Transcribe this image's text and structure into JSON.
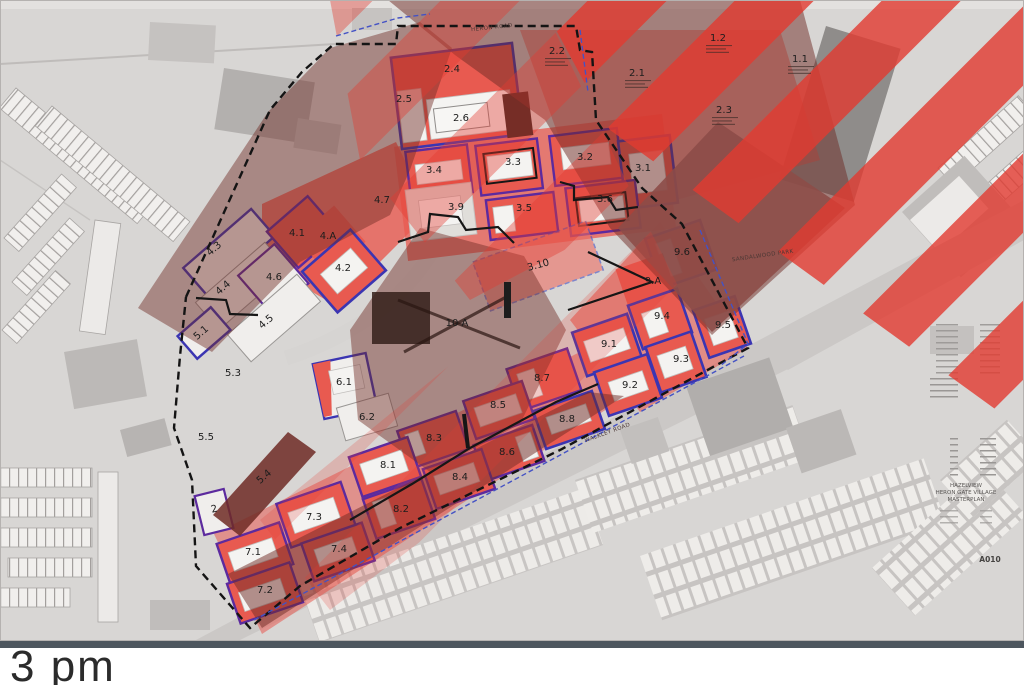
{
  "caption": {
    "text": "3 pm"
  },
  "map": {
    "colors": {
      "base": "#d8d6d4",
      "stripe": "#e23a30",
      "red": "#e85a50",
      "indigo": "#3b35b2",
      "purple": "#5c2a9e",
      "shadow": "#6e2a24",
      "park": "#8d4d48",
      "label": "#1d1d1d",
      "boundary": "#141414",
      "bar": "#4d565e",
      "caption": "#2b2b2b"
    },
    "parcel_labels": [
      {
        "t": "1.1",
        "x": 800,
        "y": 62
      },
      {
        "t": "1.2",
        "x": 718,
        "y": 41
      },
      {
        "t": "2.1",
        "x": 637,
        "y": 76
      },
      {
        "t": "2.2",
        "x": 557,
        "y": 54
      },
      {
        "t": "2.3",
        "x": 724,
        "y": 113
      },
      {
        "t": "2.4",
        "x": 452,
        "y": 72
      },
      {
        "t": "2.5",
        "x": 404,
        "y": 102
      },
      {
        "t": "2.6",
        "x": 461,
        "y": 121
      },
      {
        "t": "3.1",
        "x": 643,
        "y": 171
      },
      {
        "t": "3.2",
        "x": 585,
        "y": 160
      },
      {
        "t": "3.3",
        "x": 513,
        "y": 165
      },
      {
        "t": "3.4",
        "x": 434,
        "y": 173
      },
      {
        "t": "3.5",
        "x": 524,
        "y": 211
      },
      {
        "t": "3.6",
        "x": 605,
        "y": 202
      },
      {
        "t": "3.9",
        "x": 456,
        "y": 210
      },
      {
        "t": "3.10",
        "x": 539,
        "y": 268,
        "r": -15
      },
      {
        "t": "4.1",
        "x": 297,
        "y": 236
      },
      {
        "t": "4.A",
        "x": 328,
        "y": 239
      },
      {
        "t": "4.2",
        "x": 343,
        "y": 271
      },
      {
        "t": "4.3",
        "x": 216,
        "y": 251,
        "r": -41
      },
      {
        "t": "4.4",
        "x": 225,
        "y": 290,
        "r": -41
      },
      {
        "t": "4.5",
        "x": 268,
        "y": 324,
        "r": -41
      },
      {
        "t": "4.6",
        "x": 274,
        "y": 280
      },
      {
        "t": "4.7",
        "x": 382,
        "y": 203
      },
      {
        "t": "5.1",
        "x": 203,
        "y": 335,
        "r": -41
      },
      {
        "t": "5.3",
        "x": 233,
        "y": 376
      },
      {
        "t": "5.4",
        "x": 266,
        "y": 479,
        "r": -41
      },
      {
        "t": "5.5",
        "x": 206,
        "y": 440
      },
      {
        "t": "2",
        "x": 215,
        "y": 512,
        "r": -14
      },
      {
        "t": "6.1",
        "x": 344,
        "y": 385
      },
      {
        "t": "6.2",
        "x": 367,
        "y": 420
      },
      {
        "t": "7.1",
        "x": 253,
        "y": 555
      },
      {
        "t": "7.2",
        "x": 265,
        "y": 593
      },
      {
        "t": "7.3",
        "x": 314,
        "y": 520
      },
      {
        "t": "7.4",
        "x": 339,
        "y": 552
      },
      {
        "t": "8.1",
        "x": 388,
        "y": 468
      },
      {
        "t": "8.2",
        "x": 401,
        "y": 512
      },
      {
        "t": "8.3",
        "x": 434,
        "y": 441
      },
      {
        "t": "8.4",
        "x": 460,
        "y": 480
      },
      {
        "t": "8.5",
        "x": 498,
        "y": 408
      },
      {
        "t": "8.6",
        "x": 507,
        "y": 455
      },
      {
        "t": "8.7",
        "x": 542,
        "y": 381
      },
      {
        "t": "8.8",
        "x": 567,
        "y": 422
      },
      {
        "t": "9.1",
        "x": 609,
        "y": 347
      },
      {
        "t": "9.2",
        "x": 630,
        "y": 388
      },
      {
        "t": "9.3",
        "x": 681,
        "y": 362
      },
      {
        "t": "9.4",
        "x": 662,
        "y": 319
      },
      {
        "t": "9.5",
        "x": 723,
        "y": 328
      },
      {
        "t": "9.6",
        "x": 682,
        "y": 255
      },
      {
        "t": "9.A",
        "x": 653,
        "y": 284
      },
      {
        "t": "10 A",
        "x": 457,
        "y": 326
      }
    ],
    "area_labels": [
      {
        "t": "HERON ROAD",
        "x": 492,
        "y": 29,
        "r": -6,
        "c": "road-lbl",
        "n": "heron-road-label"
      },
      {
        "t": "WALKLEY ROAD",
        "x": 608,
        "y": 434,
        "r": -20,
        "c": "road-lbl",
        "n": "walkley-road-label"
      },
      {
        "t": "SANDALWOOD PARK",
        "x": 763,
        "y": 257,
        "r": -8,
        "c": "road-lbl",
        "n": "sandalwood-park-label"
      }
    ],
    "title_block": [
      {
        "t": "HAZELVIEW",
        "x": 966,
        "y": 487,
        "c": "tiny-lbl",
        "n": "titleblock-line"
      },
      {
        "t": "HERON GATE VILLAGE",
        "x": 966,
        "y": 494,
        "c": "tiny-lbl",
        "n": "titleblock-line"
      },
      {
        "t": "MASTERPLAN",
        "x": 966,
        "y": 501,
        "c": "tiny-lbl",
        "n": "titleblock-line"
      },
      {
        "t": "A010",
        "x": 990,
        "y": 562,
        "c": "sheet-lbl",
        "n": "sheet-number"
      }
    ]
  }
}
